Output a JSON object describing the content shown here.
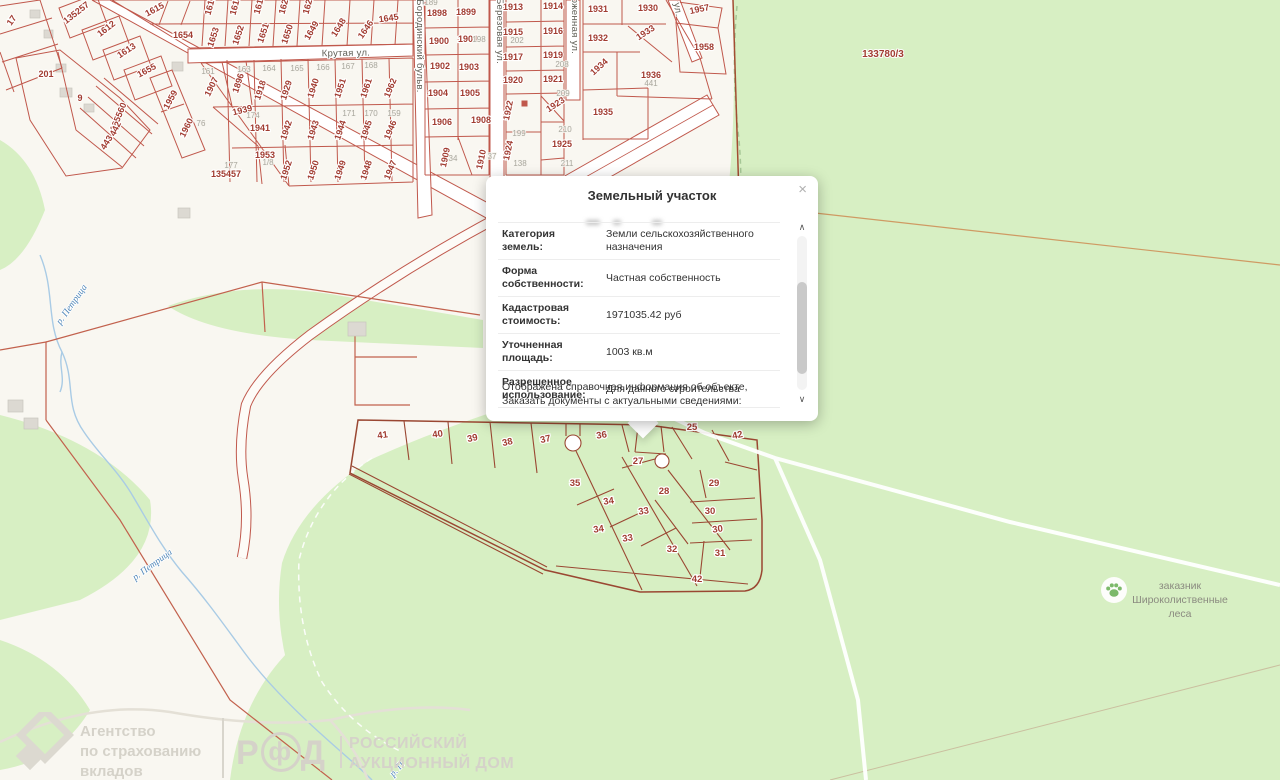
{
  "popup": {
    "title": "Земельный участок",
    "close": "×",
    "rows": [
      {
        "label": "Категория земель:",
        "value": "Земли сельскохозяйственного назначения"
      },
      {
        "label": "Форма собственности:",
        "value": "Частная собственность"
      },
      {
        "label": "Кадастровая стоимость:",
        "value": "1971035.42 руб"
      },
      {
        "label": "Уточненная площадь:",
        "value": "1003 кв.м"
      },
      {
        "label": "Разрешенное использование:",
        "value": "Для дачного строительства"
      }
    ],
    "footer_line1": "Отображена справочная информация об объекте,",
    "footer_line2": "Заказать документы с актуальными сведениями:",
    "scroll_up": "∧",
    "scroll_down": "∨"
  },
  "badge": {
    "line1": "заказник",
    "line2": "Широколиственные",
    "line3": "леса"
  },
  "watermarks": {
    "asv_line1": "Агентство",
    "asv_line2": "по страхованию",
    "asv_line3": "вкладов",
    "rad_letter_1": "Р",
    "rad_letter_2": "ф",
    "rad_letter_3": "Д",
    "rad_line1": "РОССИЙСКИЙ",
    "rad_line2": "АУКЦИОННЫЙ ДОМ"
  },
  "map": {
    "colors": {
      "forest": "#d7efc3",
      "ground": "#f9f7f1",
      "parcel_line": "#c0584c",
      "cluster_line": "#9a4732",
      "label_red": "#a13c31",
      "river": "#a9cbe5"
    },
    "labels": [
      {
        "t": "17",
        "x": 14,
        "y": 22,
        "r": -55,
        "k": "p"
      },
      {
        "t": "135257",
        "x": 78,
        "y": 15,
        "r": -38,
        "k": "p",
        "s": 10
      },
      {
        "t": "1612",
        "x": 108,
        "y": 31,
        "r": -38,
        "k": "p"
      },
      {
        "t": "1613",
        "x": 128,
        "y": 53,
        "r": -33,
        "k": "p"
      },
      {
        "t": "1655",
        "x": 148,
        "y": 73,
        "r": -28,
        "k": "p"
      },
      {
        "t": "201",
        "x": 46,
        "y": 77,
        "r": 0,
        "k": "p"
      },
      {
        "t": "9",
        "x": 80,
        "y": 101,
        "r": 0,
        "k": "p",
        "s": 10
      },
      {
        "t": "135560",
        "x": 121,
        "y": 118,
        "r": -68,
        "k": "p"
      },
      {
        "t": "442",
        "x": 118,
        "y": 130,
        "r": -64,
        "k": "p"
      },
      {
        "t": "443",
        "x": 109,
        "y": 144,
        "r": -58,
        "k": "p"
      },
      {
        "t": "1959",
        "x": 173,
        "y": 101,
        "r": -62,
        "k": "p"
      },
      {
        "t": "1960",
        "x": 189,
        "y": 129,
        "r": -64,
        "k": "p"
      },
      {
        "t": "1907",
        "x": 214,
        "y": 88,
        "r": -64,
        "k": "p"
      },
      {
        "t": "1896",
        "x": 241,
        "y": 84,
        "r": -72,
        "k": "p"
      },
      {
        "t": "1939",
        "x": 243,
        "y": 113,
        "r": -14,
        "k": "p"
      },
      {
        "t": "1941",
        "x": 260,
        "y": 131,
        "r": 0,
        "k": "p"
      },
      {
        "t": "1953",
        "x": 265,
        "y": 158,
        "r": 0,
        "k": "p"
      },
      {
        "t": "135457",
        "x": 226,
        "y": 177,
        "r": 0,
        "k": "p",
        "s": 10
      },
      {
        "t": "1615",
        "x": 156,
        "y": 12,
        "r": -28,
        "k": "p",
        "s": 11
      },
      {
        "t": "1617",
        "x": 213,
        "y": 6,
        "r": -75,
        "k": "p"
      },
      {
        "t": "1618",
        "x": 238,
        "y": 6,
        "r": -75,
        "k": "p"
      },
      {
        "t": "1619",
        "x": 262,
        "y": 5,
        "r": -75,
        "k": "p"
      },
      {
        "t": "1620",
        "x": 287,
        "y": 5,
        "r": -75,
        "k": "p"
      },
      {
        "t": "1621",
        "x": 311,
        "y": 5,
        "r": -75,
        "k": "p"
      },
      {
        "t": "1654",
        "x": 183,
        "y": 38,
        "r": 0,
        "k": "p"
      },
      {
        "t": "1653",
        "x": 216,
        "y": 38,
        "r": -72,
        "k": "p"
      },
      {
        "t": "1652",
        "x": 241,
        "y": 36,
        "r": -72,
        "k": "p"
      },
      {
        "t": "1651",
        "x": 266,
        "y": 34,
        "r": -72,
        "k": "p"
      },
      {
        "t": "1650",
        "x": 290,
        "y": 35,
        "r": -72,
        "k": "p"
      },
      {
        "t": "1649",
        "x": 314,
        "y": 32,
        "r": -60,
        "k": "p"
      },
      {
        "t": "1648",
        "x": 341,
        "y": 29,
        "r": -58,
        "k": "p"
      },
      {
        "t": "1646",
        "x": 368,
        "y": 31,
        "r": -55,
        "k": "p"
      },
      {
        "t": "1645",
        "x": 389,
        "y": 21,
        "r": -8,
        "k": "p"
      },
      {
        "t": "1918",
        "x": 263,
        "y": 91,
        "r": -72,
        "k": "p"
      },
      {
        "t": "1929",
        "x": 289,
        "y": 91,
        "r": -72,
        "k": "p"
      },
      {
        "t": "1940",
        "x": 316,
        "y": 89,
        "r": -72,
        "k": "p"
      },
      {
        "t": "1951",
        "x": 343,
        "y": 89,
        "r": -72,
        "k": "p"
      },
      {
        "t": "1961",
        "x": 369,
        "y": 89,
        "r": -72,
        "k": "p"
      },
      {
        "t": "1962",
        "x": 393,
        "y": 89,
        "r": -68,
        "k": "p"
      },
      {
        "t": "1942",
        "x": 289,
        "y": 131,
        "r": -72,
        "k": "p"
      },
      {
        "t": "1943",
        "x": 316,
        "y": 131,
        "r": -72,
        "k": "p"
      },
      {
        "t": "1944",
        "x": 343,
        "y": 131,
        "r": -72,
        "k": "p"
      },
      {
        "t": "1945",
        "x": 369,
        "y": 131,
        "r": -72,
        "k": "p"
      },
      {
        "t": "1946",
        "x": 393,
        "y": 131,
        "r": -68,
        "k": "p"
      },
      {
        "t": "1952",
        "x": 289,
        "y": 171,
        "r": -72,
        "k": "p"
      },
      {
        "t": "1950",
        "x": 316,
        "y": 171,
        "r": -72,
        "k": "p"
      },
      {
        "t": "1949",
        "x": 343,
        "y": 171,
        "r": -72,
        "k": "p"
      },
      {
        "t": "1948",
        "x": 369,
        "y": 171,
        "r": -72,
        "k": "p"
      },
      {
        "t": "1947",
        "x": 393,
        "y": 171,
        "r": -68,
        "k": "p"
      },
      {
        "t": "1898",
        "x": 437,
        "y": 16,
        "r": 0,
        "k": "p"
      },
      {
        "t": "1899",
        "x": 466,
        "y": 15,
        "r": 0,
        "k": "p"
      },
      {
        "t": "1900",
        "x": 439,
        "y": 44,
        "r": 0,
        "k": "p"
      },
      {
        "t": "1901",
        "x": 468,
        "y": 42,
        "r": 0,
        "k": "p"
      },
      {
        "t": "1902",
        "x": 440,
        "y": 69,
        "r": 0,
        "k": "p"
      },
      {
        "t": "1903",
        "x": 469,
        "y": 70,
        "r": 0,
        "k": "p"
      },
      {
        "t": "1904",
        "x": 438,
        "y": 96,
        "r": 0,
        "k": "p"
      },
      {
        "t": "1905",
        "x": 470,
        "y": 96,
        "r": 0,
        "k": "p"
      },
      {
        "t": "1906",
        "x": 442,
        "y": 125,
        "r": 0,
        "k": "p"
      },
      {
        "t": "1908",
        "x": 481,
        "y": 123,
        "r": 0,
        "k": "p"
      },
      {
        "t": "1909",
        "x": 448,
        "y": 158,
        "r": -78,
        "k": "p"
      },
      {
        "t": "1910",
        "x": 484,
        "y": 160,
        "r": -78,
        "k": "p"
      },
      {
        "t": "1913",
        "x": 513,
        "y": 10,
        "r": 0,
        "k": "p"
      },
      {
        "t": "1914",
        "x": 553,
        "y": 9,
        "r": 0,
        "k": "p"
      },
      {
        "t": "1915",
        "x": 513,
        "y": 35,
        "r": 0,
        "k": "p"
      },
      {
        "t": "1916",
        "x": 553,
        "y": 34,
        "r": 0,
        "k": "p"
      },
      {
        "t": "1917",
        "x": 513,
        "y": 60,
        "r": 0,
        "k": "p"
      },
      {
        "t": "1919",
        "x": 553,
        "y": 58,
        "r": 0,
        "k": "p"
      },
      {
        "t": "1920",
        "x": 513,
        "y": 83,
        "r": 0,
        "k": "p"
      },
      {
        "t": "1921",
        "x": 553,
        "y": 82,
        "r": 0,
        "k": "p"
      },
      {
        "t": "1922",
        "x": 511,
        "y": 111,
        "r": -78,
        "k": "p"
      },
      {
        "t": "1923",
        "x": 557,
        "y": 107,
        "r": -33,
        "k": "p"
      },
      {
        "t": "1924",
        "x": 511,
        "y": 151,
        "r": -78,
        "k": "p"
      },
      {
        "t": "1925",
        "x": 562,
        "y": 147,
        "r": 0,
        "k": "p"
      },
      {
        "t": "1931",
        "x": 598,
        "y": 12,
        "r": 0,
        "k": "p"
      },
      {
        "t": "1930",
        "x": 648,
        "y": 11,
        "r": 0,
        "k": "p"
      },
      {
        "t": "1932",
        "x": 598,
        "y": 41,
        "r": 0,
        "k": "p"
      },
      {
        "t": "1933",
        "x": 647,
        "y": 35,
        "r": -33,
        "k": "p"
      },
      {
        "t": "1934",
        "x": 601,
        "y": 69,
        "r": -42,
        "k": "p"
      },
      {
        "t": "1936",
        "x": 651,
        "y": 78,
        "r": 0,
        "k": "p"
      },
      {
        "t": "1935",
        "x": 603,
        "y": 115,
        "r": 0,
        "k": "p"
      },
      {
        "t": "1957",
        "x": 700,
        "y": 12,
        "r": -12,
        "k": "p"
      },
      {
        "t": "1958",
        "x": 704,
        "y": 50,
        "r": 0,
        "k": "p"
      },
      {
        "t": "161",
        "x": 208,
        "y": 74,
        "r": 0,
        "k": "g"
      },
      {
        "t": "163",
        "x": 244,
        "y": 72,
        "r": 0,
        "k": "g"
      },
      {
        "t": "164",
        "x": 269,
        "y": 71,
        "r": 0,
        "k": "g"
      },
      {
        "t": "165",
        "x": 297,
        "y": 71,
        "r": 0,
        "k": "g"
      },
      {
        "t": "166",
        "x": 323,
        "y": 70,
        "r": 0,
        "k": "g"
      },
      {
        "t": "167",
        "x": 348,
        "y": 69,
        "r": 0,
        "k": "g"
      },
      {
        "t": "168",
        "x": 371,
        "y": 68,
        "r": 0,
        "k": "g"
      },
      {
        "t": "76",
        "x": 201,
        "y": 126,
        "r": 0,
        "k": "g"
      },
      {
        "t": "174",
        "x": 253,
        "y": 118,
        "r": 0,
        "k": "g"
      },
      {
        "t": "171",
        "x": 349,
        "y": 116,
        "r": 0,
        "k": "g"
      },
      {
        "t": "170",
        "x": 371,
        "y": 116,
        "r": 0,
        "k": "g"
      },
      {
        "t": "159",
        "x": 394,
        "y": 116,
        "r": 0,
        "k": "g"
      },
      {
        "t": "177",
        "x": 231,
        "y": 168,
        "r": 0,
        "k": "g"
      },
      {
        "t": "1/8",
        "x": 268,
        "y": 165,
        "r": 0,
        "k": "g"
      },
      {
        "t": "189",
        "x": 431,
        "y": 5,
        "r": 0,
        "k": "g"
      },
      {
        "t": "198",
        "x": 479,
        "y": 42,
        "r": 0,
        "k": "g"
      },
      {
        "t": "202",
        "x": 517,
        "y": 43,
        "r": 0,
        "k": "g"
      },
      {
        "t": "208",
        "x": 562,
        "y": 67,
        "r": 0,
        "k": "g"
      },
      {
        "t": "209",
        "x": 563,
        "y": 96,
        "r": 0,
        "k": "g"
      },
      {
        "t": "210",
        "x": 565,
        "y": 132,
        "r": 0,
        "k": "g"
      },
      {
        "t": "211",
        "x": 567,
        "y": 166,
        "r": 0,
        "k": "g"
      },
      {
        "t": "199",
        "x": 519,
        "y": 136,
        "r": 0,
        "k": "g"
      },
      {
        "t": "138",
        "x": 520,
        "y": 166,
        "r": 0,
        "k": "g"
      },
      {
        "t": "34",
        "x": 453,
        "y": 161,
        "r": 0,
        "k": "g"
      },
      {
        "t": "37",
        "x": 492,
        "y": 159,
        "r": 0,
        "k": "g"
      },
      {
        "t": "441",
        "x": 651,
        "y": 86,
        "r": 0,
        "k": "g"
      },
      {
        "t": "41",
        "x": 383,
        "y": 438,
        "r": -8,
        "k": "c"
      },
      {
        "t": "40",
        "x": 438,
        "y": 437,
        "r": -8,
        "k": "c"
      },
      {
        "t": "39",
        "x": 473,
        "y": 441,
        "r": -12,
        "k": "c"
      },
      {
        "t": "38",
        "x": 508,
        "y": 445,
        "r": -12,
        "k": "c"
      },
      {
        "t": "37",
        "x": 546,
        "y": 442,
        "r": -12,
        "k": "c"
      },
      {
        "t": "36",
        "x": 602,
        "y": 438,
        "r": -8,
        "k": "c"
      },
      {
        "t": "26",
        "x": 647,
        "y": 428,
        "r": -8,
        "k": "c"
      },
      {
        "t": "25",
        "x": 692,
        "y": 430,
        "r": 0,
        "k": "c"
      },
      {
        "t": "42",
        "x": 738,
        "y": 438,
        "r": -12,
        "k": "c"
      },
      {
        "t": "27",
        "x": 638,
        "y": 464,
        "r": 0,
        "k": "c"
      },
      {
        "t": "35",
        "x": 575,
        "y": 486,
        "r": 0,
        "k": "c"
      },
      {
        "t": "34",
        "x": 609,
        "y": 504,
        "r": -8,
        "k": "c"
      },
      {
        "t": "33",
        "x": 644,
        "y": 514,
        "r": -8,
        "k": "c"
      },
      {
        "t": "28",
        "x": 664,
        "y": 494,
        "r": 0,
        "k": "c"
      },
      {
        "t": "29",
        "x": 714,
        "y": 486,
        "r": 0,
        "k": "c"
      },
      {
        "t": "30",
        "x": 710,
        "y": 514,
        "r": 0,
        "k": "c"
      },
      {
        "t": "30",
        "x": 718,
        "y": 532,
        "r": -8,
        "k": "c"
      },
      {
        "t": "31",
        "x": 720,
        "y": 556,
        "r": 0,
        "k": "c"
      },
      {
        "t": "32",
        "x": 672,
        "y": 552,
        "r": 0,
        "k": "c"
      },
      {
        "t": "33",
        "x": 628,
        "y": 541,
        "r": -8,
        "k": "c"
      },
      {
        "t": "34",
        "x": 599,
        "y": 532,
        "r": -8,
        "k": "c"
      },
      {
        "t": "42",
        "x": 697,
        "y": 582,
        "r": 0,
        "k": "c"
      },
      {
        "t": "133780/3",
        "x": 883,
        "y": 57,
        "r": 0,
        "k": "a"
      },
      {
        "t": "Крутая ул.",
        "x": 346,
        "y": 56,
        "r": -1,
        "k": "s",
        "s": 10
      },
      {
        "t": "Бородинский бульв.",
        "x": 417,
        "y": 46,
        "r": 90,
        "k": "s"
      },
      {
        "t": "Березовая ул.",
        "x": 497,
        "y": 31,
        "r": 90,
        "k": "s"
      },
      {
        "t": "оженная ул.",
        "x": 572,
        "y": 26,
        "r": 90,
        "k": "s"
      },
      {
        "t": "ул.",
        "x": 675,
        "y": 10,
        "r": 80,
        "k": "s"
      },
      {
        "t": "р. Петрица",
        "x": 74,
        "y": 306,
        "r": -55,
        "k": "r"
      },
      {
        "t": "р. Петрица",
        "x": 154,
        "y": 567,
        "r": -36,
        "k": "r"
      },
      {
        "t": "р. П",
        "x": 399,
        "y": 771,
        "r": -48,
        "k": "r"
      }
    ]
  }
}
